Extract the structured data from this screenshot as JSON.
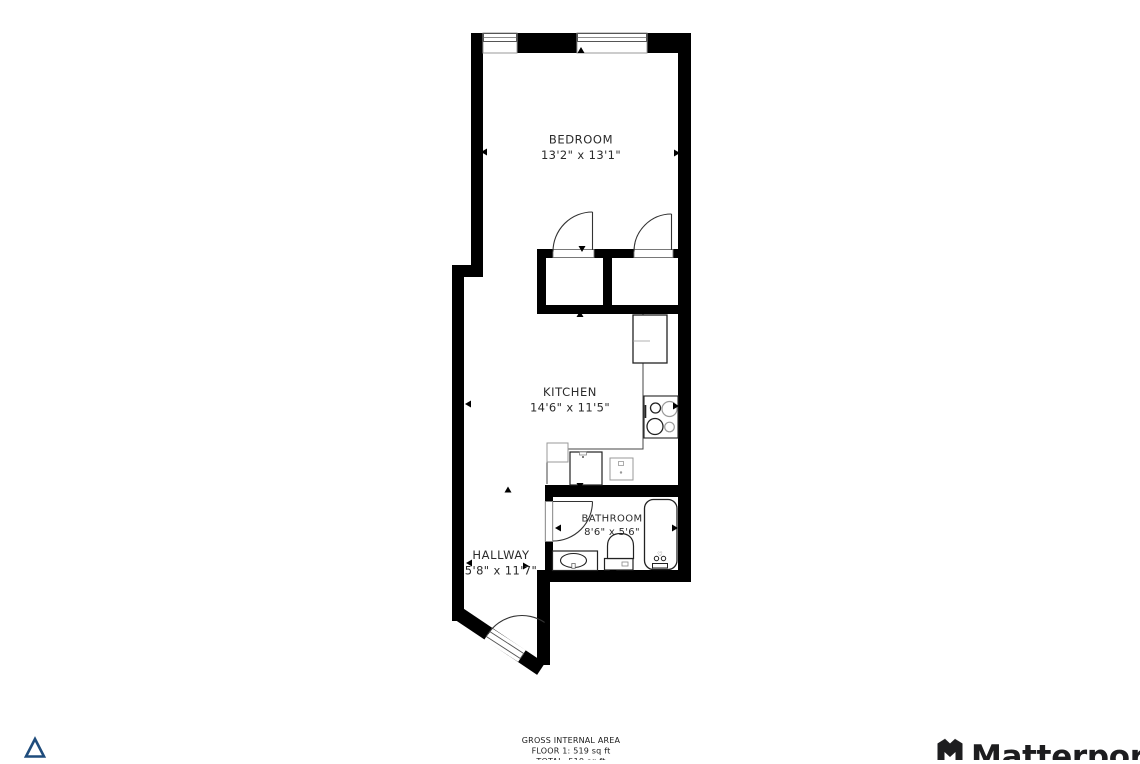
{
  "rooms": {
    "bedroom": {
      "name": "BEDROOM",
      "dims": "13'2\" x 13'1\""
    },
    "kitchen": {
      "name": "KITCHEN",
      "dims": "14'6\" x 11'5\""
    },
    "bathroom": {
      "name": "BATHROOM",
      "dims": "8'6\" x 5'6\""
    },
    "hallway": {
      "name": "HALLWAY",
      "dims": "5'8\" x 11'7\""
    }
  },
  "footer": {
    "gross_area_label": "GROSS INTERNAL AREA",
    "floor1_area": "FLOOR 1: 519 sq ft",
    "total_area": "TOTAL: 519 sq ft"
  },
  "branding": {
    "name": "Matterport"
  },
  "icons": {
    "north_indicator": "triangle-outline",
    "logo_mark": "matterport-m"
  },
  "colors": {
    "wall": "#000000",
    "accent_triangle": "#1f4c7c",
    "label_text": "#2b2b2b",
    "logo_text": "#1d1d1f"
  }
}
